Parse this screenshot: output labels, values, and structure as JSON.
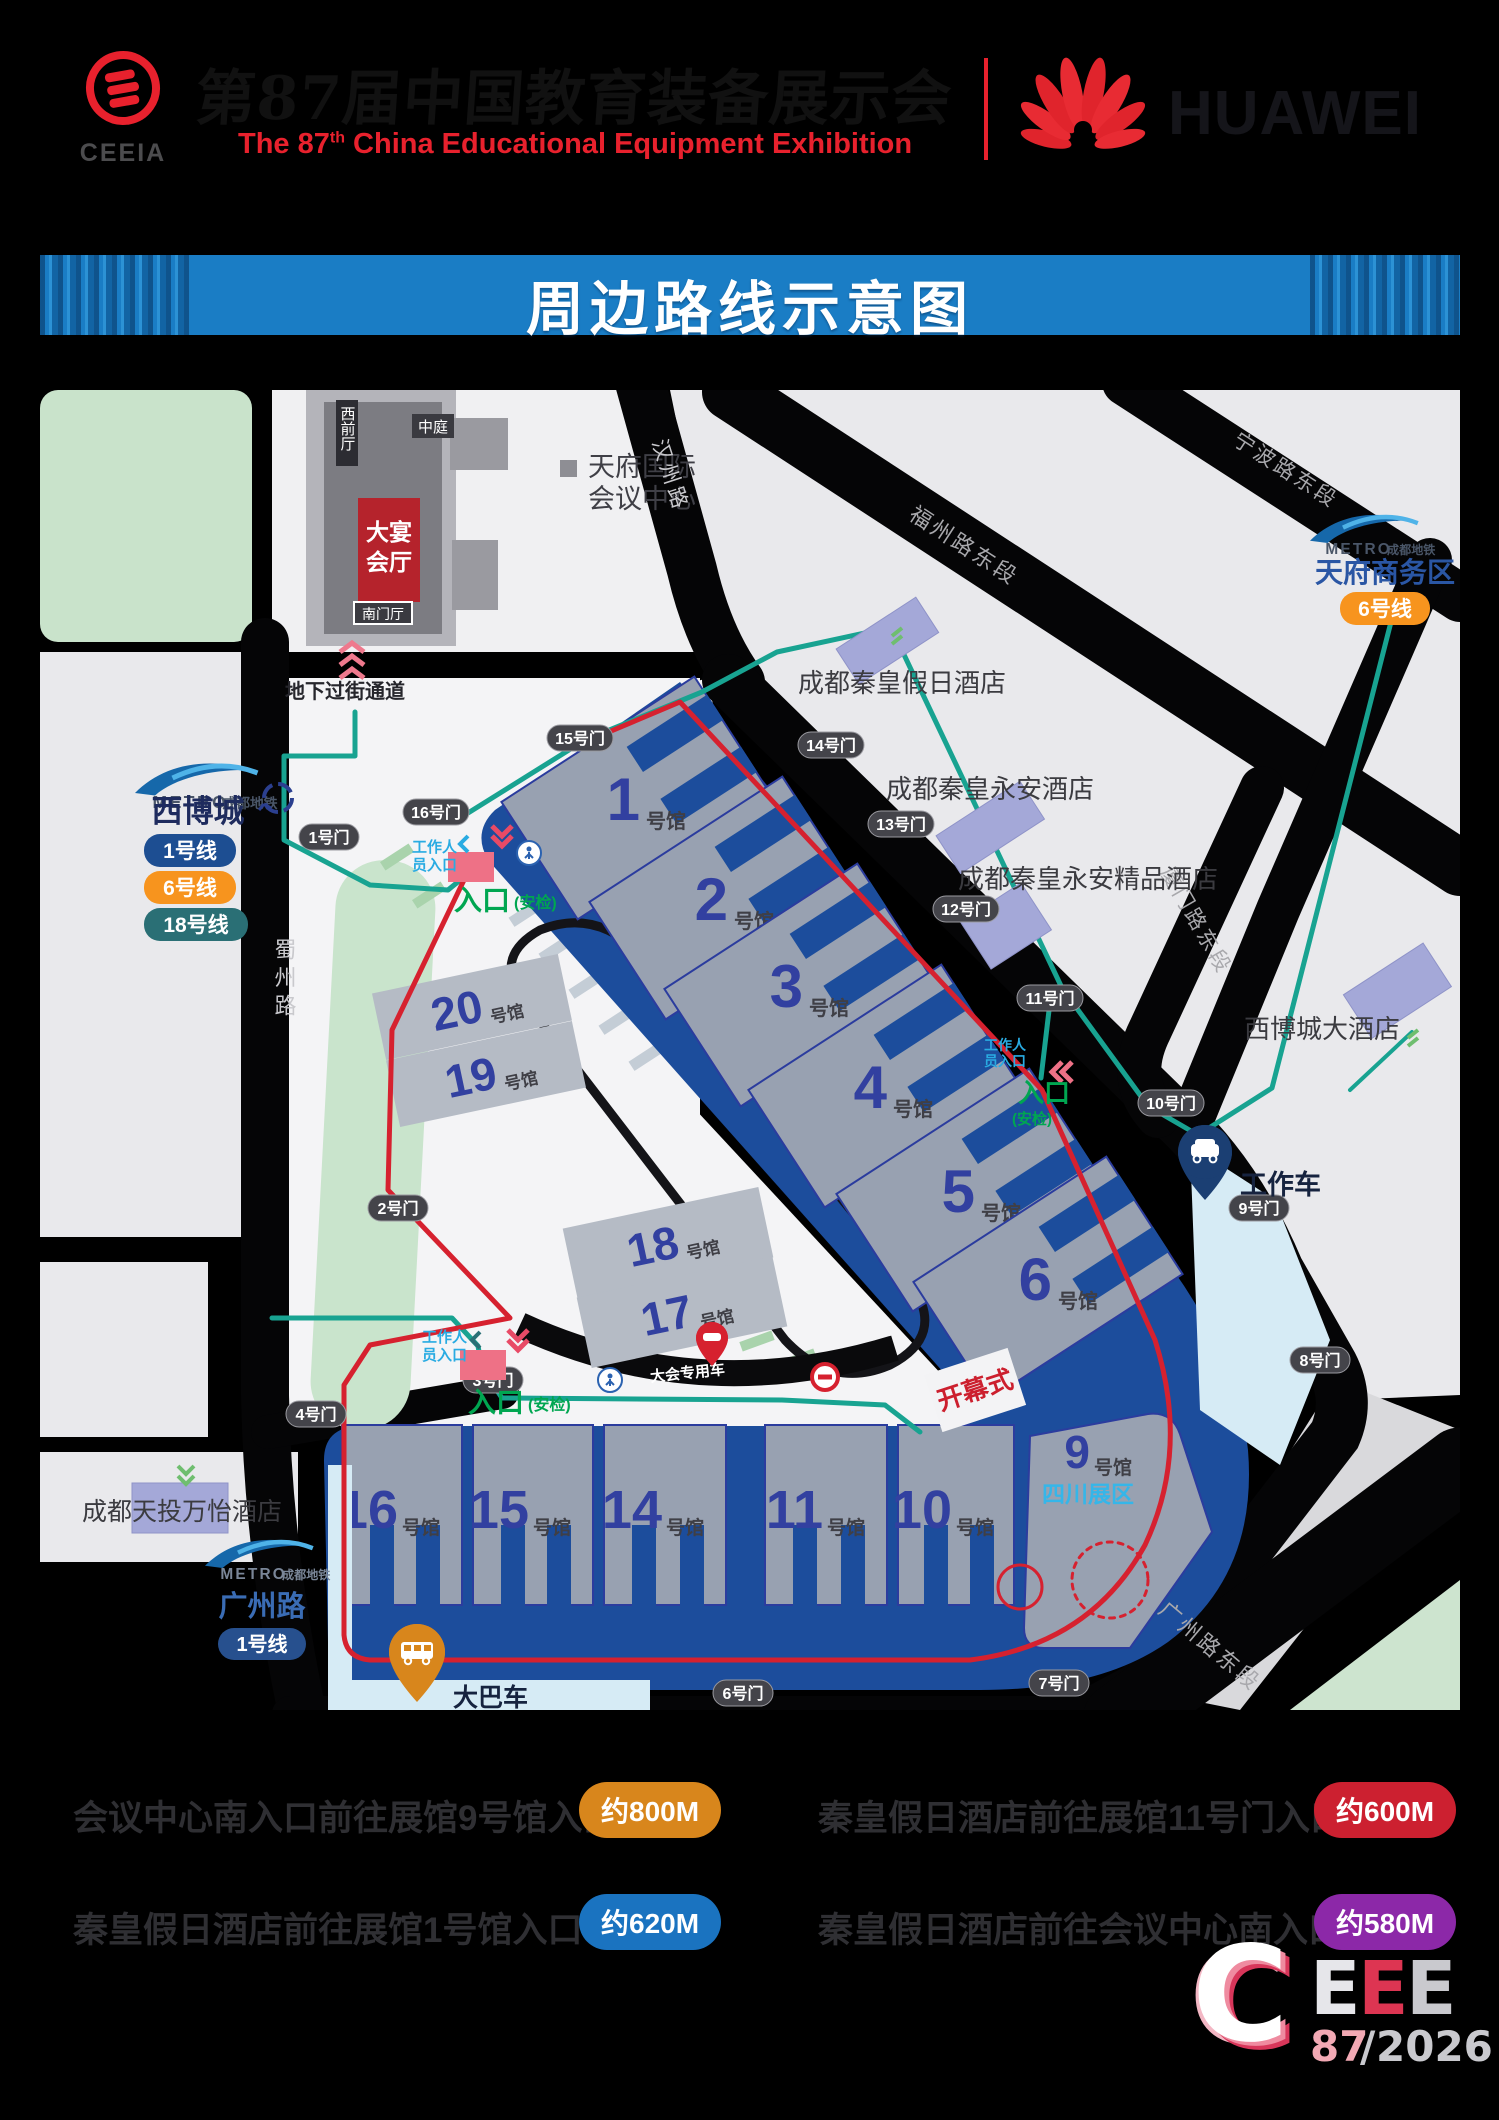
{
  "header": {
    "ceeia": "CEEIA",
    "title_cn": "第87届中国教育装备展示会",
    "title_en_pre": "The 87",
    "title_en_sup": "th",
    "title_en_post": " China  Educational  Equipment  Exhibition",
    "huawei": "HUAWEI"
  },
  "banner": {
    "title": "周边路线示意图"
  },
  "colors": {
    "venue_navy": "#1c4d9c",
    "route_red": "#d6212f",
    "route_teal": "#18a391",
    "banner_blue": "#1a7dc5",
    "hotel_purple": "#a4a8d8",
    "badge_orange": "#d8861c",
    "badge_blue": "#1a73c0",
    "badge_red": "#cc2030",
    "badge_purple": "#8c28a8",
    "line1": "#1d4e92",
    "line6": "#f7941e",
    "line18": "#2a6f75"
  },
  "map": {
    "convention": {
      "west_hall": "西前厅",
      "atrium": "中庭",
      "banquet_l1": "大宴",
      "banquet_l2": "会厅",
      "south_hall": "南门厅",
      "center_l1": "天府国际",
      "center_l2": "会议中心",
      "underpass": "地下过街通道"
    },
    "roads": {
      "hanzhou": "汉州路",
      "fuzhou": "福州路东段",
      "ningbo": "宁波路东段",
      "xiamen": "厦门路东段",
      "guangzhou": "广州路东段",
      "shuzhou": "蜀州路"
    },
    "metro": {
      "brand": "METRO",
      "brand_cn": "成都地铁",
      "xibocheng": {
        "name": "西博城",
        "line1": "1号线",
        "line6": "6号线",
        "line18": "18号线"
      },
      "tianfu": {
        "name": "天府商务区",
        "line6": "6号线"
      },
      "guangzhoulu": {
        "name": "广州路",
        "line1": "1号线"
      }
    },
    "hotels": {
      "holiday": "成都秦皇假日酒店",
      "yongan": "成都秦皇永安酒店",
      "boutique": "成都秦皇永安精品酒店",
      "xibo": "西博城大酒店",
      "wanyi": "成都天投万怡酒店"
    },
    "halls": {
      "suffix": "号馆",
      "h1": "1",
      "h2": "2",
      "h3": "3",
      "h4": "4",
      "h5": "5",
      "h6": "6",
      "h20": "20",
      "h19": "19",
      "h18": "18",
      "h17": "17",
      "h16": "16",
      "h15": "15",
      "h14": "14",
      "h11": "11",
      "h10": "10",
      "h9": "9",
      "sichuan": "四川展区"
    },
    "gates": {
      "g1": "1号门",
      "g2": "2号门",
      "g3": "3号门",
      "g4": "4号门",
      "g6": "6号门",
      "g7": "7号门",
      "g8": "8号门",
      "g9": "9号门",
      "g10": "10号门",
      "g11": "11号门",
      "g12": "12号门",
      "g13": "13号门",
      "g14": "14号门",
      "g15": "15号门",
      "g16": "16号门"
    },
    "entrances": {
      "main": "入口",
      "security": "(安检)",
      "staff_l1": "工作人",
      "staff_l2": "员入口"
    },
    "pins": {
      "work_car": "工作车",
      "bus": "大巴车",
      "conf_car": "大会专用车"
    },
    "opening": "开幕式"
  },
  "legend": {
    "r1l": {
      "text": "会议中心南入口前往展馆9号馆入口",
      "dist": "约800M"
    },
    "r2l": {
      "text": "秦皇假日酒店前往展馆1号馆入口",
      "dist": "约620M"
    },
    "r1r": {
      "text": "秦皇假日酒店前往展馆11号门入口",
      "dist": "约600M"
    },
    "r2r": {
      "text": "秦皇假日酒店前往会议中心南入口",
      "dist": "约580M"
    }
  },
  "footer": {
    "c": "C",
    "e1": "E",
    "e2": "E",
    "e3": "E",
    "num": "87",
    "slash": "/",
    "year": "2026"
  }
}
